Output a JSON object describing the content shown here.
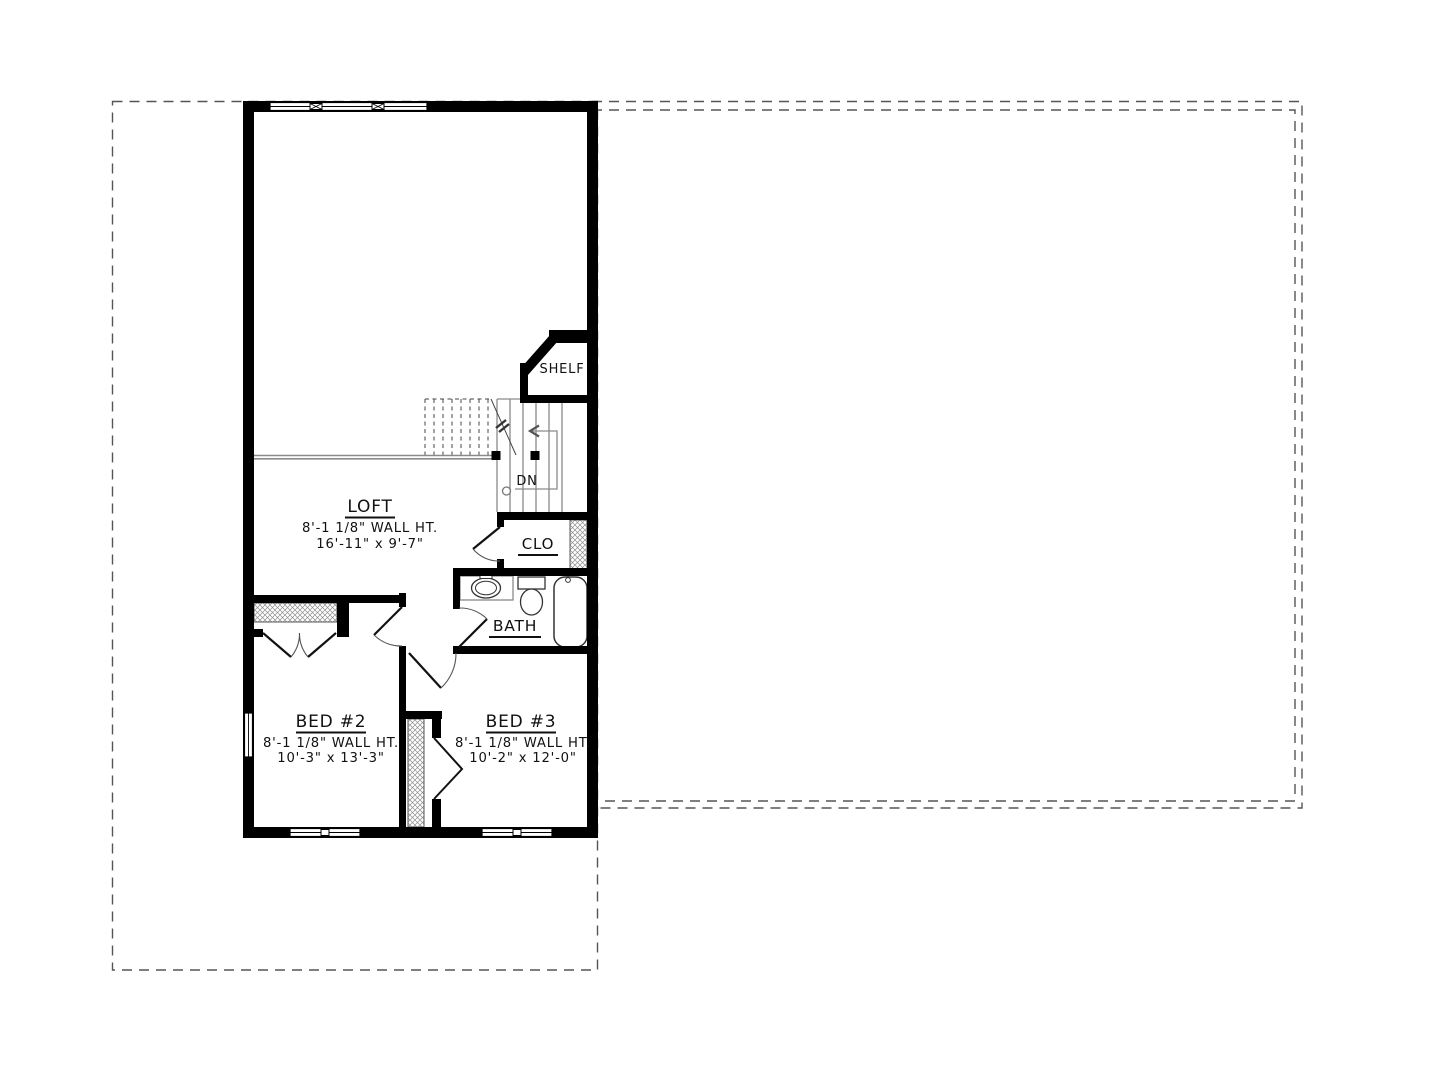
{
  "rooms": {
    "loft": {
      "name": "LOFT",
      "wall_height": "8'-1 1/8\" WALL HT.",
      "size": "16'-11\" x 9'-7\""
    },
    "bed2": {
      "name": "BED #2",
      "wall_height": "8'-1 1/8\" WALL HT.",
      "size": "10'-3\" x 13'-3\""
    },
    "bed3": {
      "name": "BED #3",
      "wall_height": "8'-1 1/8\" WALL HT.",
      "size": "10'-2\" x 12'-0\""
    },
    "bath": {
      "name": "BATH"
    },
    "clo": {
      "name": "CLO"
    },
    "shelf": {
      "name": "SHELF"
    }
  },
  "stairs": {
    "down_label": "DN"
  },
  "colors": {
    "wall": "#000000",
    "annotation": "#111111",
    "thin_line": "#8a8a8a",
    "dashed_outline": "#555555",
    "background": "#ffffff"
  }
}
